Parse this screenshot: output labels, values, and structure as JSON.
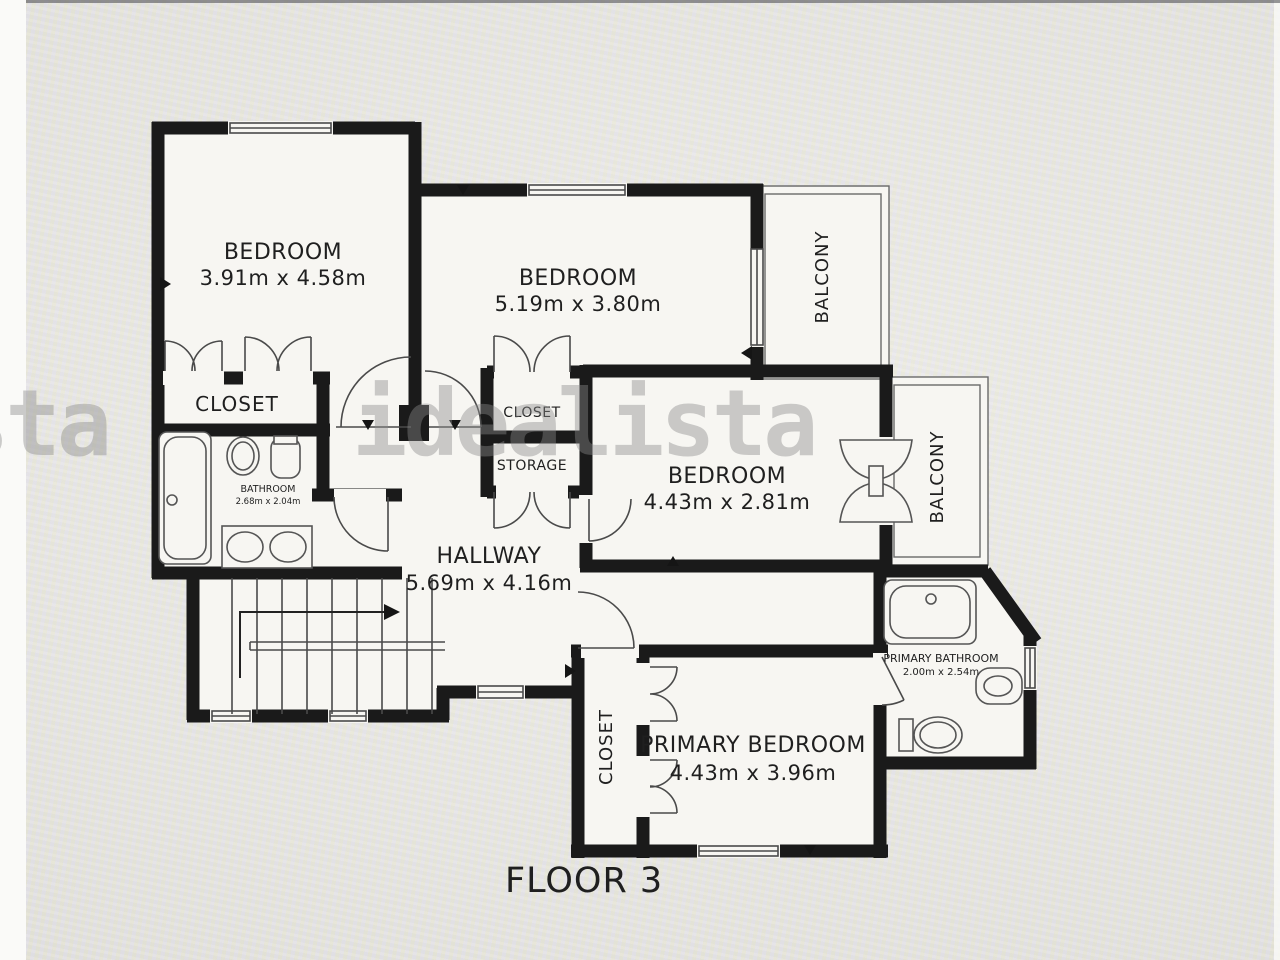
{
  "floorplan": {
    "floor_label": "FLOOR 3",
    "watermark": {
      "text": "idealista",
      "fragment": "sta"
    },
    "rooms": {
      "bedroom1": {
        "name": "BEDROOM",
        "dims": "3.91m x 4.58m"
      },
      "bedroom2": {
        "name": "BEDROOM",
        "dims": "5.19m x 3.80m"
      },
      "bedroom3": {
        "name": "BEDROOM",
        "dims": "4.43m x 2.81m"
      },
      "primary_bedroom": {
        "name": "PRIMARY BEDROOM",
        "dims": "4.43m x 3.96m"
      },
      "hallway": {
        "name": "HALLWAY",
        "dims": "5.69m x 4.16m"
      },
      "bathroom": {
        "name": "BATHROOM",
        "dims": "2.68m x 2.04m"
      },
      "primary_bathroom": {
        "name": "PRIMARY BATHROOM",
        "dims": "2.00m x 2.54m"
      },
      "closet_left": "CLOSET",
      "closet_mid": "CLOSET",
      "storage": "STORAGE",
      "closet_primary": "CLOSET",
      "balcony_top": "BALCONY",
      "balcony_right": "BALCONY"
    },
    "colors": {
      "wall": "#1a1a1a",
      "floor": "#f7f6f2",
      "line": "#4a4a4a",
      "text": "#1f1f1f",
      "watermark": "#8a8a8a"
    }
  }
}
